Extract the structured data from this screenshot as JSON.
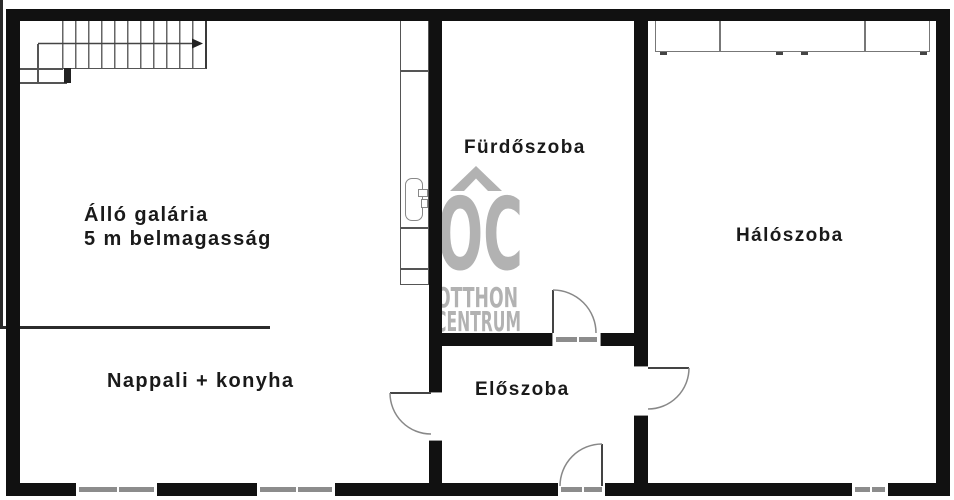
{
  "meta": {
    "type": "apartment floor plan",
    "language": "hu"
  },
  "rooms": {
    "gallery": {
      "label_line1": "Álló galária",
      "label_line2": "5 m belmagasság"
    },
    "living_kitchen": {
      "label": "Nappali + konyha"
    },
    "bathroom": {
      "label": "Fürdőszoba"
    },
    "hallway": {
      "label": "Előszoba"
    },
    "bedroom": {
      "label": "Hálószoba"
    }
  },
  "watermark": {
    "monogram": "OC",
    "word1": "OTTHON",
    "word2": "CENTRUM",
    "color": "#b2b2b2"
  },
  "symbols": {
    "stairs": "staircase-with-direction-arrow",
    "sink": "washbasin",
    "wardrobe": "wardrobe-3-sections",
    "doors": "quarter-circle-door-swing",
    "windows": "double-line-window"
  },
  "colors": {
    "wall": "#111111",
    "thin_line": "#555555",
    "window_bar": "#8c8c8c",
    "door_arc": "#888888",
    "label_text": "#1a1a1a",
    "background": "#ffffff",
    "watermark": "#b2b2b2"
  }
}
